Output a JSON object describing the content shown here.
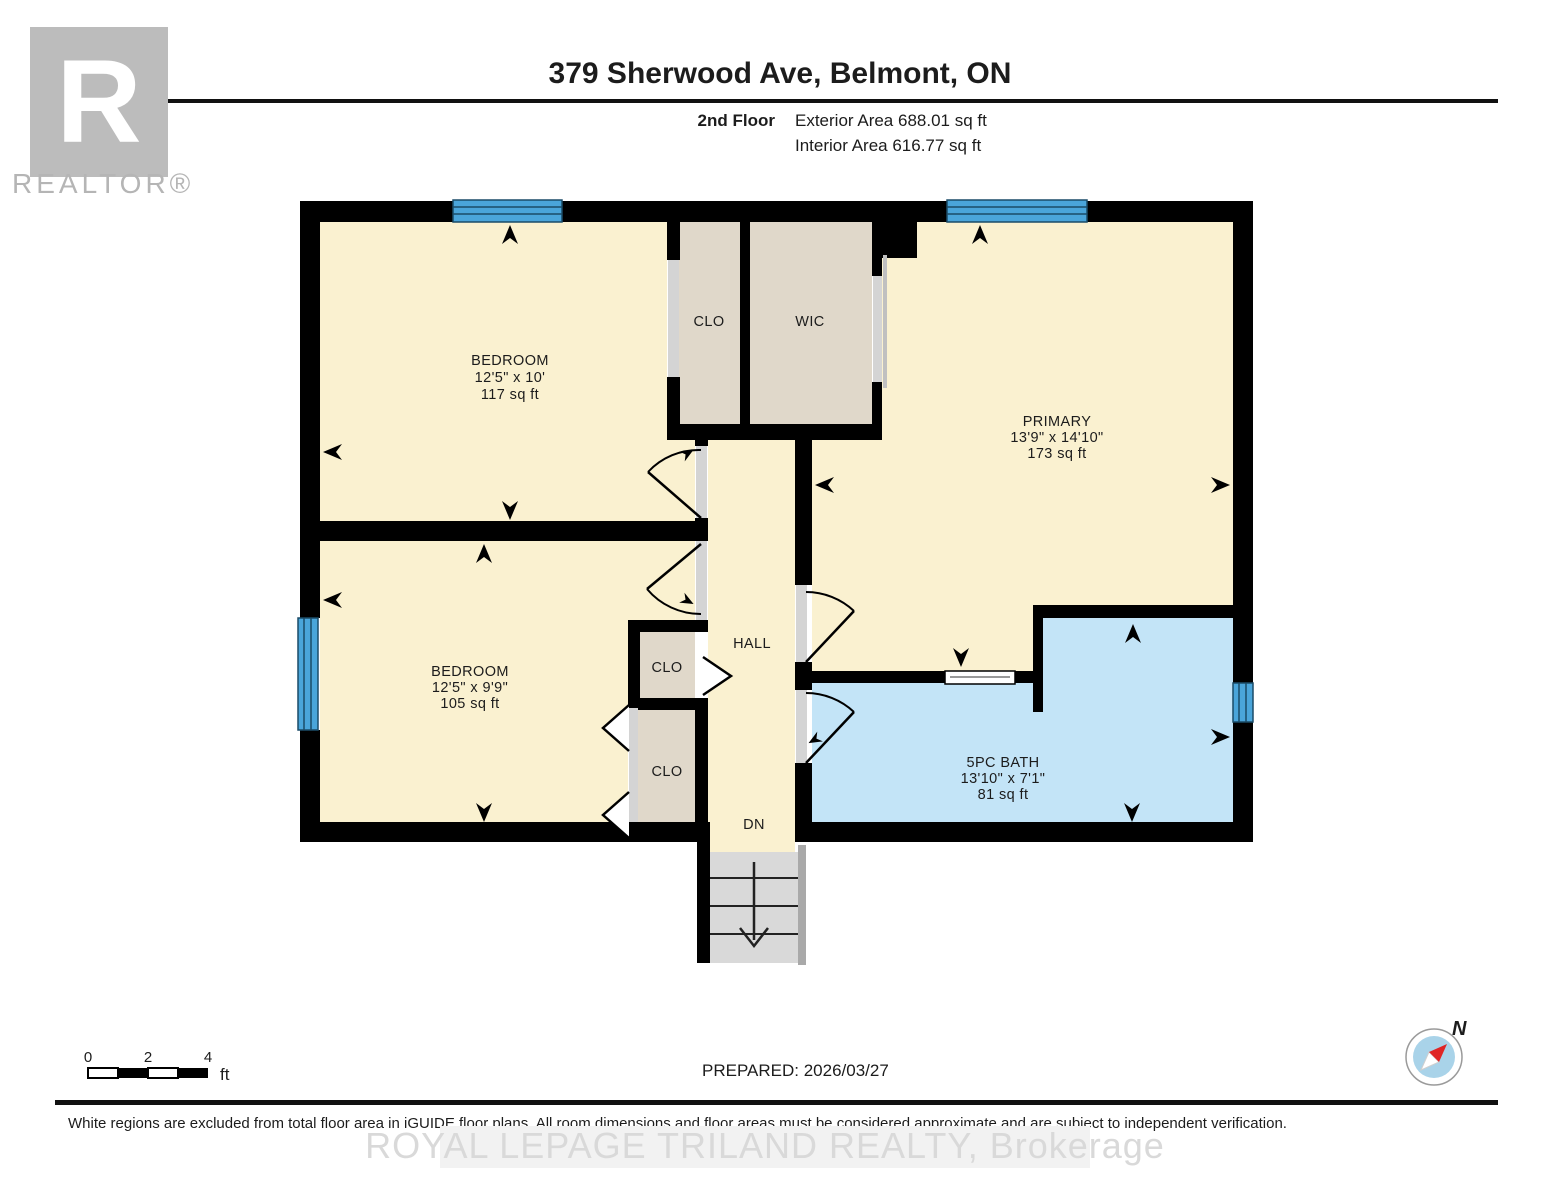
{
  "header": {
    "title": "379 Sherwood Ave, Belmont, ON",
    "floor_label": "2nd Floor",
    "exterior_area": "Exterior Area 688.01 sq ft",
    "interior_area": "Interior Area 616.77 sq ft"
  },
  "logo": {
    "letter": "R",
    "realtor": "REALTOR®"
  },
  "rooms": {
    "bedroom1": {
      "name": "BEDROOM",
      "dims": "12'5\" x 10'",
      "area": "117 sq ft"
    },
    "clo_top": {
      "name": "CLO"
    },
    "wic": {
      "name": "WIC"
    },
    "primary": {
      "name": "PRIMARY",
      "dims": "13'9\" x 14'10\"",
      "area": "173 sq ft"
    },
    "bedroom2": {
      "name": "BEDROOM",
      "dims": "12'5\" x 9'9\"",
      "area": "105 sq ft"
    },
    "clo_mid": {
      "name": "CLO"
    },
    "clo_bottom": {
      "name": "CLO"
    },
    "hall": {
      "name": "HALL"
    },
    "stairs_label": "DN",
    "bath": {
      "name": "5PC BATH",
      "dims": "13'10\" x 7'1\"",
      "area": "81 sq ft"
    }
  },
  "scale_bar": {
    "t0": "0",
    "t2": "2",
    "t4": "4",
    "unit": "ft"
  },
  "compass": {
    "n": "N"
  },
  "footer": {
    "prepared": "PREPARED: 2026/03/27",
    "disclaimer": "White regions are excluded from total floor area in iGUIDE floor plans. All room dimensions and floor areas must be considered approximate and are subject to independent verification.",
    "watermark": "ROYAL LEPAGE TRILAND REALTY, Brokerage"
  },
  "colors": {
    "room_fill": "#faf1d0",
    "closet_fill": "#e0d8ca",
    "bath_fill": "#c3e4f7",
    "window_blue": "#4aa5da",
    "wall": "#000000",
    "stairs": "#d9d9d9",
    "compass_red": "#e02525",
    "compass_blue": "#a9d3e9"
  }
}
